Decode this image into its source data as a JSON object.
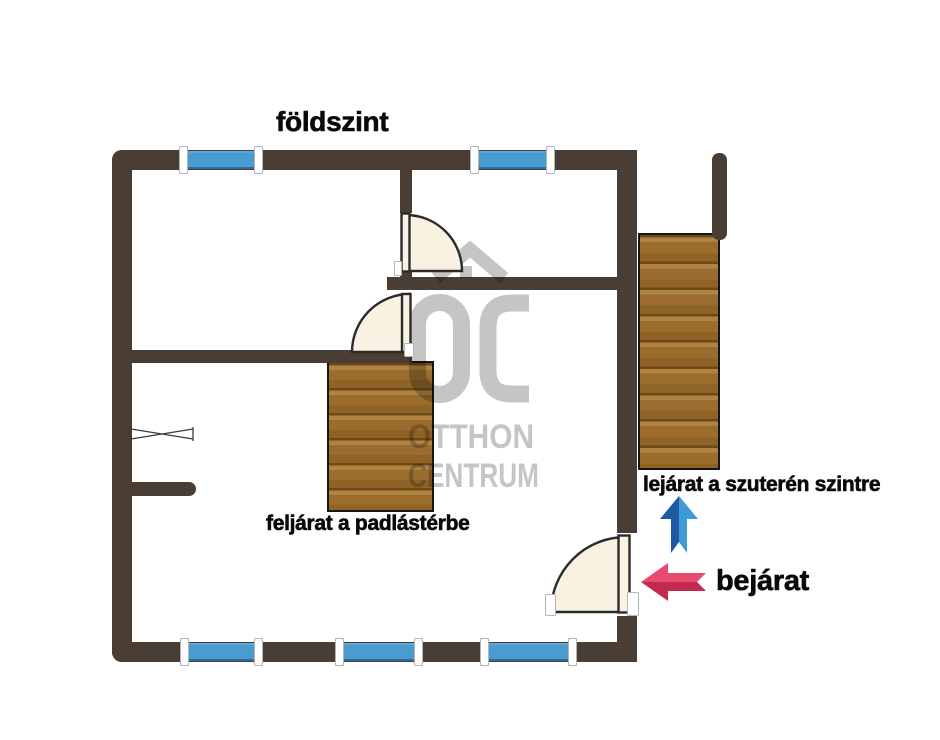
{
  "title": "földszint",
  "labels": {
    "attic": "feljárat a padlástérbe",
    "basement": "lejárat a szuterén szintre",
    "entrance": "bejárat"
  },
  "watermark": {
    "monogram": "OC",
    "line1": "OTTHON",
    "line2": "CENTRUM"
  },
  "icons": {
    "up_arrow": "blue-up-arrow",
    "entrance_arrow": "pink-left-arrow",
    "logo_roof": "house-roof"
  },
  "colors": {
    "wall": "#4a3d34",
    "window_glass": "#4a9bd0",
    "window_edge_top": "#5aa7d8",
    "window_edge_bottom": "#2b6d9d",
    "jamb_fill": "#ffffff",
    "jamb_border": "#b5b5b5",
    "door_fill": "#f9f2e3",
    "door_outline": "#2b2b2b",
    "wood_seam": "#6b4a1a",
    "wood_light": "#b08440",
    "wood_mid": "#9a6c2e",
    "wood_dark": "#8f6226",
    "stairs_outline": "#161616",
    "watermark": "#c5c5c5",
    "arrow_blue_dark": "#1d5aa3",
    "arrow_blue_light": "#3f9ad8",
    "arrow_pink_light": "#e94a6f",
    "arrow_pink_dark": "#c22a52",
    "label_text": "#0a0a0a"
  }
}
